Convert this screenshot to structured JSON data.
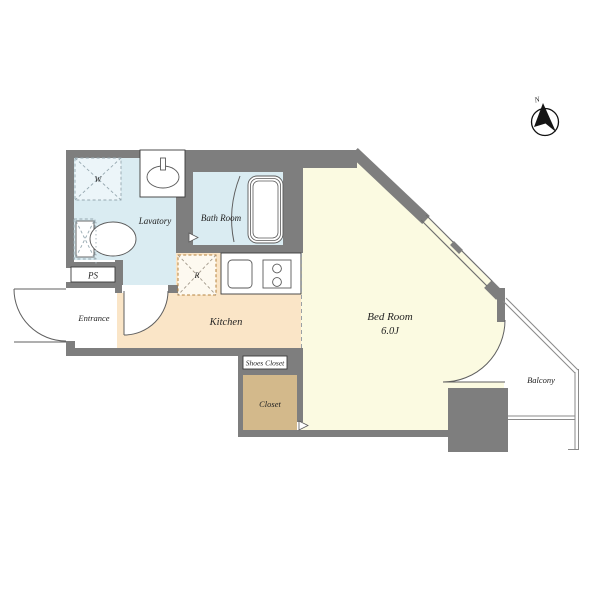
{
  "colors": {
    "wall": "#7e7e7e",
    "water_room": "#daecf2",
    "washer_pad": "#ecf5f9",
    "kitchen": "#fae5c7",
    "bedroom": "#fbfae1",
    "closet": "#d3b98b",
    "refrigerator_pad": "#fdf9f0",
    "page_bg": "#ffffff"
  },
  "rooms": {
    "lavatory": {
      "label": "Lavatory"
    },
    "bath": {
      "label": "Bath Room"
    },
    "kitchen": {
      "label": "Kitchen"
    },
    "bedroom": {
      "label": "Bed Room",
      "area": "6.0J"
    },
    "entrance": {
      "label": "Entrance"
    },
    "ps": {
      "label": "PS"
    },
    "shoes_closet": {
      "label": "Shoes Closet"
    },
    "closet": {
      "label": "Closet"
    },
    "balcony": {
      "label": "Balcony"
    }
  },
  "fixtures": {
    "washing_machine": {
      "label": "W"
    },
    "refrigerator": {
      "label": "R"
    }
  },
  "compass": {
    "north": "N"
  }
}
